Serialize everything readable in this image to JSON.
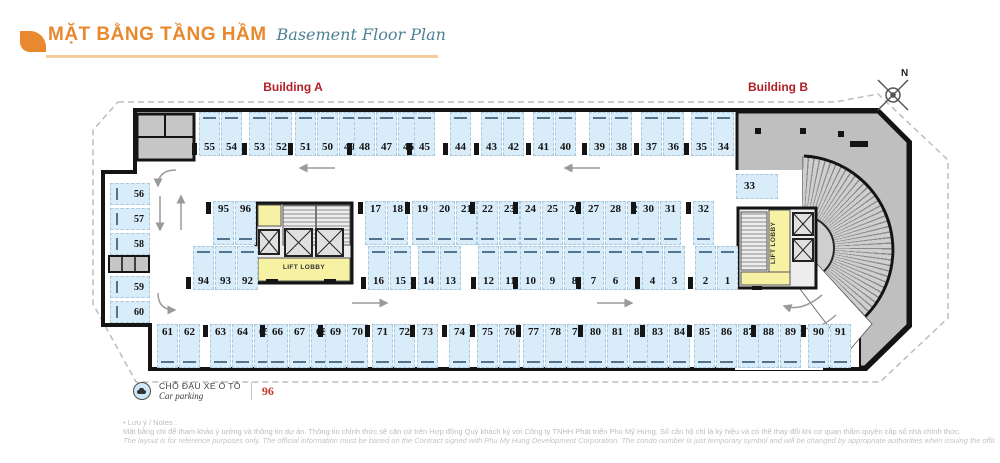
{
  "header": {
    "title": "MẶT BẰNG TẦNG HẦM",
    "subtitle": "Basement Floor Plan"
  },
  "labels": {
    "building_a": "Building A",
    "building_b": "Building B",
    "north": "N",
    "lift_lobby_a": "LIFT LOBBY",
    "lift_lobby_b": "LIFT LOBBY"
  },
  "legend": {
    "label_vi": "CHỖ ĐẬU XE Ô TÔ",
    "label_en": "Car parking",
    "count": "96"
  },
  "notes": {
    "heading": "• Lưu ý / Notes :",
    "vi": "Mặt bằng chỉ để tham khảo ý tưởng và thông tin dự án. Thông tin chính thức sẽ căn cứ trên Hợp đồng Quý khách ký với Công ty TNHH Phát triển Phú Mỹ Hưng. Số căn hộ chỉ là ký hiệu và có thể thay đổi khi cơ quan thẩm quyền cấp số nhà chính thức.",
    "en": "The layout is for reference purposes only. The official information must be based on the Contract signed with Phu My Hung Development Corporation. The condo number is just temporary symbol and will be changed by appropriate authorities when issuing the official one."
  },
  "colors": {
    "accent_orange": "#E8882F",
    "underline_peach": "#F5CBA0",
    "subtitle_teal": "#4E8096",
    "building_label_red": "#B22026",
    "spot_fill": "#D9ECF9",
    "spot_border": "#A9C7DD",
    "bumper_blue": "#54748E",
    "wall_black": "#141414",
    "core_yellow": "#F7F1A3",
    "gray_mass": "#BFBFBF",
    "legend_count_red": "#C43A2B"
  },
  "parking": {
    "total_spots": 96,
    "groups": [
      {
        "type": "num-b",
        "x": 199,
        "y": 112,
        "pillar": 1,
        "spots": [
          "55",
          "54"
        ]
      },
      {
        "type": "num-b",
        "x": 249,
        "y": 112,
        "pillar": 1,
        "spots": [
          "53",
          "52"
        ]
      },
      {
        "type": "num-b",
        "x": 295,
        "y": 112,
        "pillar": 1,
        "spots": [
          "51",
          "50",
          "49"
        ]
      },
      {
        "type": "num-b",
        "x": 354,
        "y": 112,
        "pillar": 1,
        "spots": [
          "48",
          "47",
          "46"
        ]
      },
      {
        "type": "num-b",
        "x": 414,
        "y": 112,
        "pillar": 1,
        "spots": [
          "45"
        ]
      },
      {
        "type": "num-b",
        "x": 450,
        "y": 112,
        "pillar": 1,
        "spots": [
          "44"
        ]
      },
      {
        "type": "num-b",
        "x": 481,
        "y": 112,
        "pillar": 1,
        "spots": [
          "43",
          "42"
        ]
      },
      {
        "type": "num-b",
        "x": 533,
        "y": 112,
        "pillar": 1,
        "spots": [
          "41",
          "40"
        ]
      },
      {
        "type": "num-b",
        "x": 589,
        "y": 112,
        "pillar": 1,
        "spots": [
          "39",
          "38"
        ]
      },
      {
        "type": "num-b",
        "x": 641,
        "y": 112,
        "pillar": 1,
        "spots": [
          "37",
          "36"
        ]
      },
      {
        "type": "num-b",
        "x": 691,
        "y": 112,
        "pillar": 1,
        "spots": [
          "35",
          "34"
        ]
      },
      {
        "type": "num-t",
        "x": 213,
        "y": 201,
        "pillar": 1,
        "spots": [
          "95",
          "96"
        ]
      },
      {
        "type": "num-t",
        "x": 365,
        "y": 201,
        "pillar": 1,
        "spots": [
          "17",
          "18"
        ]
      },
      {
        "type": "num-t",
        "x": 412,
        "y": 201,
        "pillar": 1,
        "spots": [
          "19",
          "20",
          "21"
        ]
      },
      {
        "type": "num-t",
        "x": 477,
        "y": 201,
        "pillar": 1,
        "spots": [
          "22",
          "23"
        ]
      },
      {
        "type": "num-t",
        "x": 520,
        "y": 201,
        "pillar": 1,
        "spots": [
          "24",
          "25",
          "26"
        ]
      },
      {
        "type": "num-t",
        "x": 583,
        "y": 201,
        "pillar": 1,
        "spots": [
          "27",
          "28",
          "29"
        ]
      },
      {
        "type": "num-t",
        "x": 638,
        "y": 201,
        "pillar": 1,
        "spots": [
          "30",
          "31"
        ]
      },
      {
        "type": "num-t",
        "x": 693,
        "y": 201,
        "pillar": 1,
        "spots": [
          "32"
        ]
      },
      {
        "type": "num-b",
        "x": 193,
        "y": 246,
        "pillar": 1,
        "spots": [
          "94",
          "93",
          "92"
        ]
      },
      {
        "type": "num-b",
        "x": 368,
        "y": 246,
        "pillar": 1,
        "spots": [
          "16",
          "15"
        ]
      },
      {
        "type": "num-b",
        "x": 418,
        "y": 246,
        "pillar": 1,
        "spots": [
          "14",
          "13"
        ]
      },
      {
        "type": "num-b",
        "x": 478,
        "y": 246,
        "pillar": 1,
        "spots": [
          "12",
          "11"
        ]
      },
      {
        "type": "num-b",
        "x": 520,
        "y": 246,
        "pillar": 1,
        "spots": [
          "10",
          "9",
          "8"
        ]
      },
      {
        "type": "num-b",
        "x": 583,
        "y": 246,
        "pillar": 1,
        "spots": [
          "7",
          "6",
          "5"
        ]
      },
      {
        "type": "num-b",
        "x": 642,
        "y": 246,
        "pillar": 1,
        "spots": [
          "4",
          "3"
        ]
      },
      {
        "type": "num-b",
        "x": 695,
        "y": 246,
        "pillar": 1,
        "spots": [
          "2",
          "1"
        ]
      },
      {
        "type": "num-t",
        "x": 157,
        "y": 324,
        "pillar": 0,
        "spots": [
          "61",
          "62"
        ]
      },
      {
        "type": "num-t",
        "x": 210,
        "y": 324,
        "pillar": 1,
        "spots": [
          "63",
          "64",
          "65"
        ]
      },
      {
        "type": "num-t",
        "x": 267,
        "y": 324,
        "pillar": 1,
        "spots": [
          "66",
          "67",
          "68"
        ]
      },
      {
        "type": "num-t",
        "x": 325,
        "y": 324,
        "pillar": 1,
        "spots": [
          "69",
          "70"
        ]
      },
      {
        "type": "num-t",
        "x": 372,
        "y": 324,
        "pillar": 1,
        "spots": [
          "71",
          "72"
        ]
      },
      {
        "type": "num-t",
        "x": 417,
        "y": 324,
        "pillar": 1,
        "spots": [
          "73"
        ]
      },
      {
        "type": "num-t",
        "x": 449,
        "y": 324,
        "pillar": 1,
        "spots": [
          "74"
        ]
      },
      {
        "type": "num-t",
        "x": 477,
        "y": 324,
        "pillar": 1,
        "spots": [
          "75",
          "76"
        ]
      },
      {
        "type": "num-t",
        "x": 523,
        "y": 324,
        "pillar": 1,
        "spots": [
          "77",
          "78",
          "79"
        ]
      },
      {
        "type": "num-t",
        "x": 585,
        "y": 324,
        "pillar": 1,
        "spots": [
          "80",
          "81",
          "82"
        ]
      },
      {
        "type": "num-t",
        "x": 647,
        "y": 324,
        "pillar": 1,
        "spots": [
          "83",
          "84"
        ]
      },
      {
        "type": "num-t",
        "x": 694,
        "y": 324,
        "pillar": 1,
        "spots": [
          "85",
          "86",
          "87"
        ]
      },
      {
        "type": "num-t",
        "x": 758,
        "y": 324,
        "pillar": 1,
        "spots": [
          "88",
          "89"
        ]
      },
      {
        "type": "num-t",
        "x": 808,
        "y": 324,
        "pillar": 1,
        "spots": [
          "90",
          "91"
        ]
      },
      {
        "type": "h",
        "x": 110,
        "y": 183,
        "pillar": 0,
        "spots": [
          "56",
          "57",
          "58"
        ]
      },
      {
        "type": "h",
        "x": 110,
        "y": 276,
        "pillar": 0,
        "spots": [
          "59",
          "60"
        ]
      },
      {
        "type": "plain",
        "x": 736,
        "y": 174,
        "pillar": 0,
        "spots": [
          "33"
        ]
      }
    ]
  }
}
